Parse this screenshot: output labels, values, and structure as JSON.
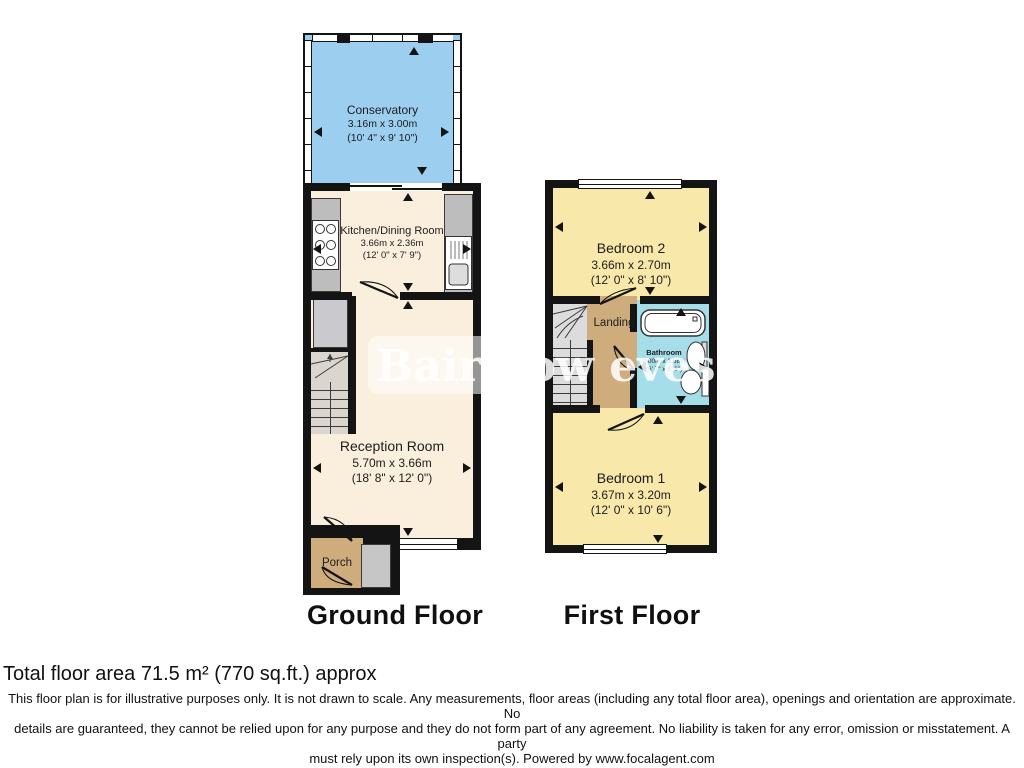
{
  "ground_floor": {
    "label": "Ground Floor",
    "conservatory": {
      "name": "Conservatory",
      "metric": "3.16m x 3.00m",
      "imperial": "(10' 4\" x 9' 10\")"
    },
    "kitchen": {
      "name": "Kitchen/Dining Room",
      "metric": "3.66m x 2.36m",
      "imperial": "(12' 0\" x 7' 9\")"
    },
    "reception": {
      "name": "Reception Room",
      "metric": "5.70m x 3.66m",
      "imperial": "(18' 8\" x 12' 0\")"
    },
    "porch": {
      "name": "Porch"
    }
  },
  "first_floor": {
    "label": "First Floor",
    "bedroom2": {
      "name": "Bedroom 2",
      "metric": "3.66m x 2.70m",
      "imperial": "(12' 0\" x 8' 10\")"
    },
    "landing": {
      "name": "Landing"
    },
    "bathroom": {
      "name": "Bathroom",
      "metric": "2.00m x 1.68m",
      "imperial": "(6' 7\" x 5' 6\")"
    },
    "bedroom1": {
      "name": "Bedroom 1",
      "metric": "3.67m x 3.20m",
      "imperial": "(12' 0\" x 10' 6\")"
    }
  },
  "watermark": "Bairstow eves",
  "footer": {
    "total_area": "Total floor area 71.5 m² (770 sq.ft.) approx",
    "disclaimer": [
      "This floor plan is for illustrative purposes only. It is not drawn to scale. Any measurements, floor areas (including any total floor area), openings and orientation are approximate. No",
      "details are guaranteed, they cannot be relied upon for any purpose and they do not form part of any agreement. No liability is taken for any error, omission or misstatement. A party",
      "must rely upon its own inspection(s). Powered by www.focalagent.com"
    ]
  },
  "colors": {
    "wall": "#141414",
    "conservatory": "#9CCEF0",
    "living_cream": "#FAEFDC",
    "bedroom_yellow": "#F8E8AA",
    "hall_tan": "#CEAC7C",
    "bathroom_cyan": "#A5DEE8",
    "fixture_gray": "#BDBDBD"
  }
}
